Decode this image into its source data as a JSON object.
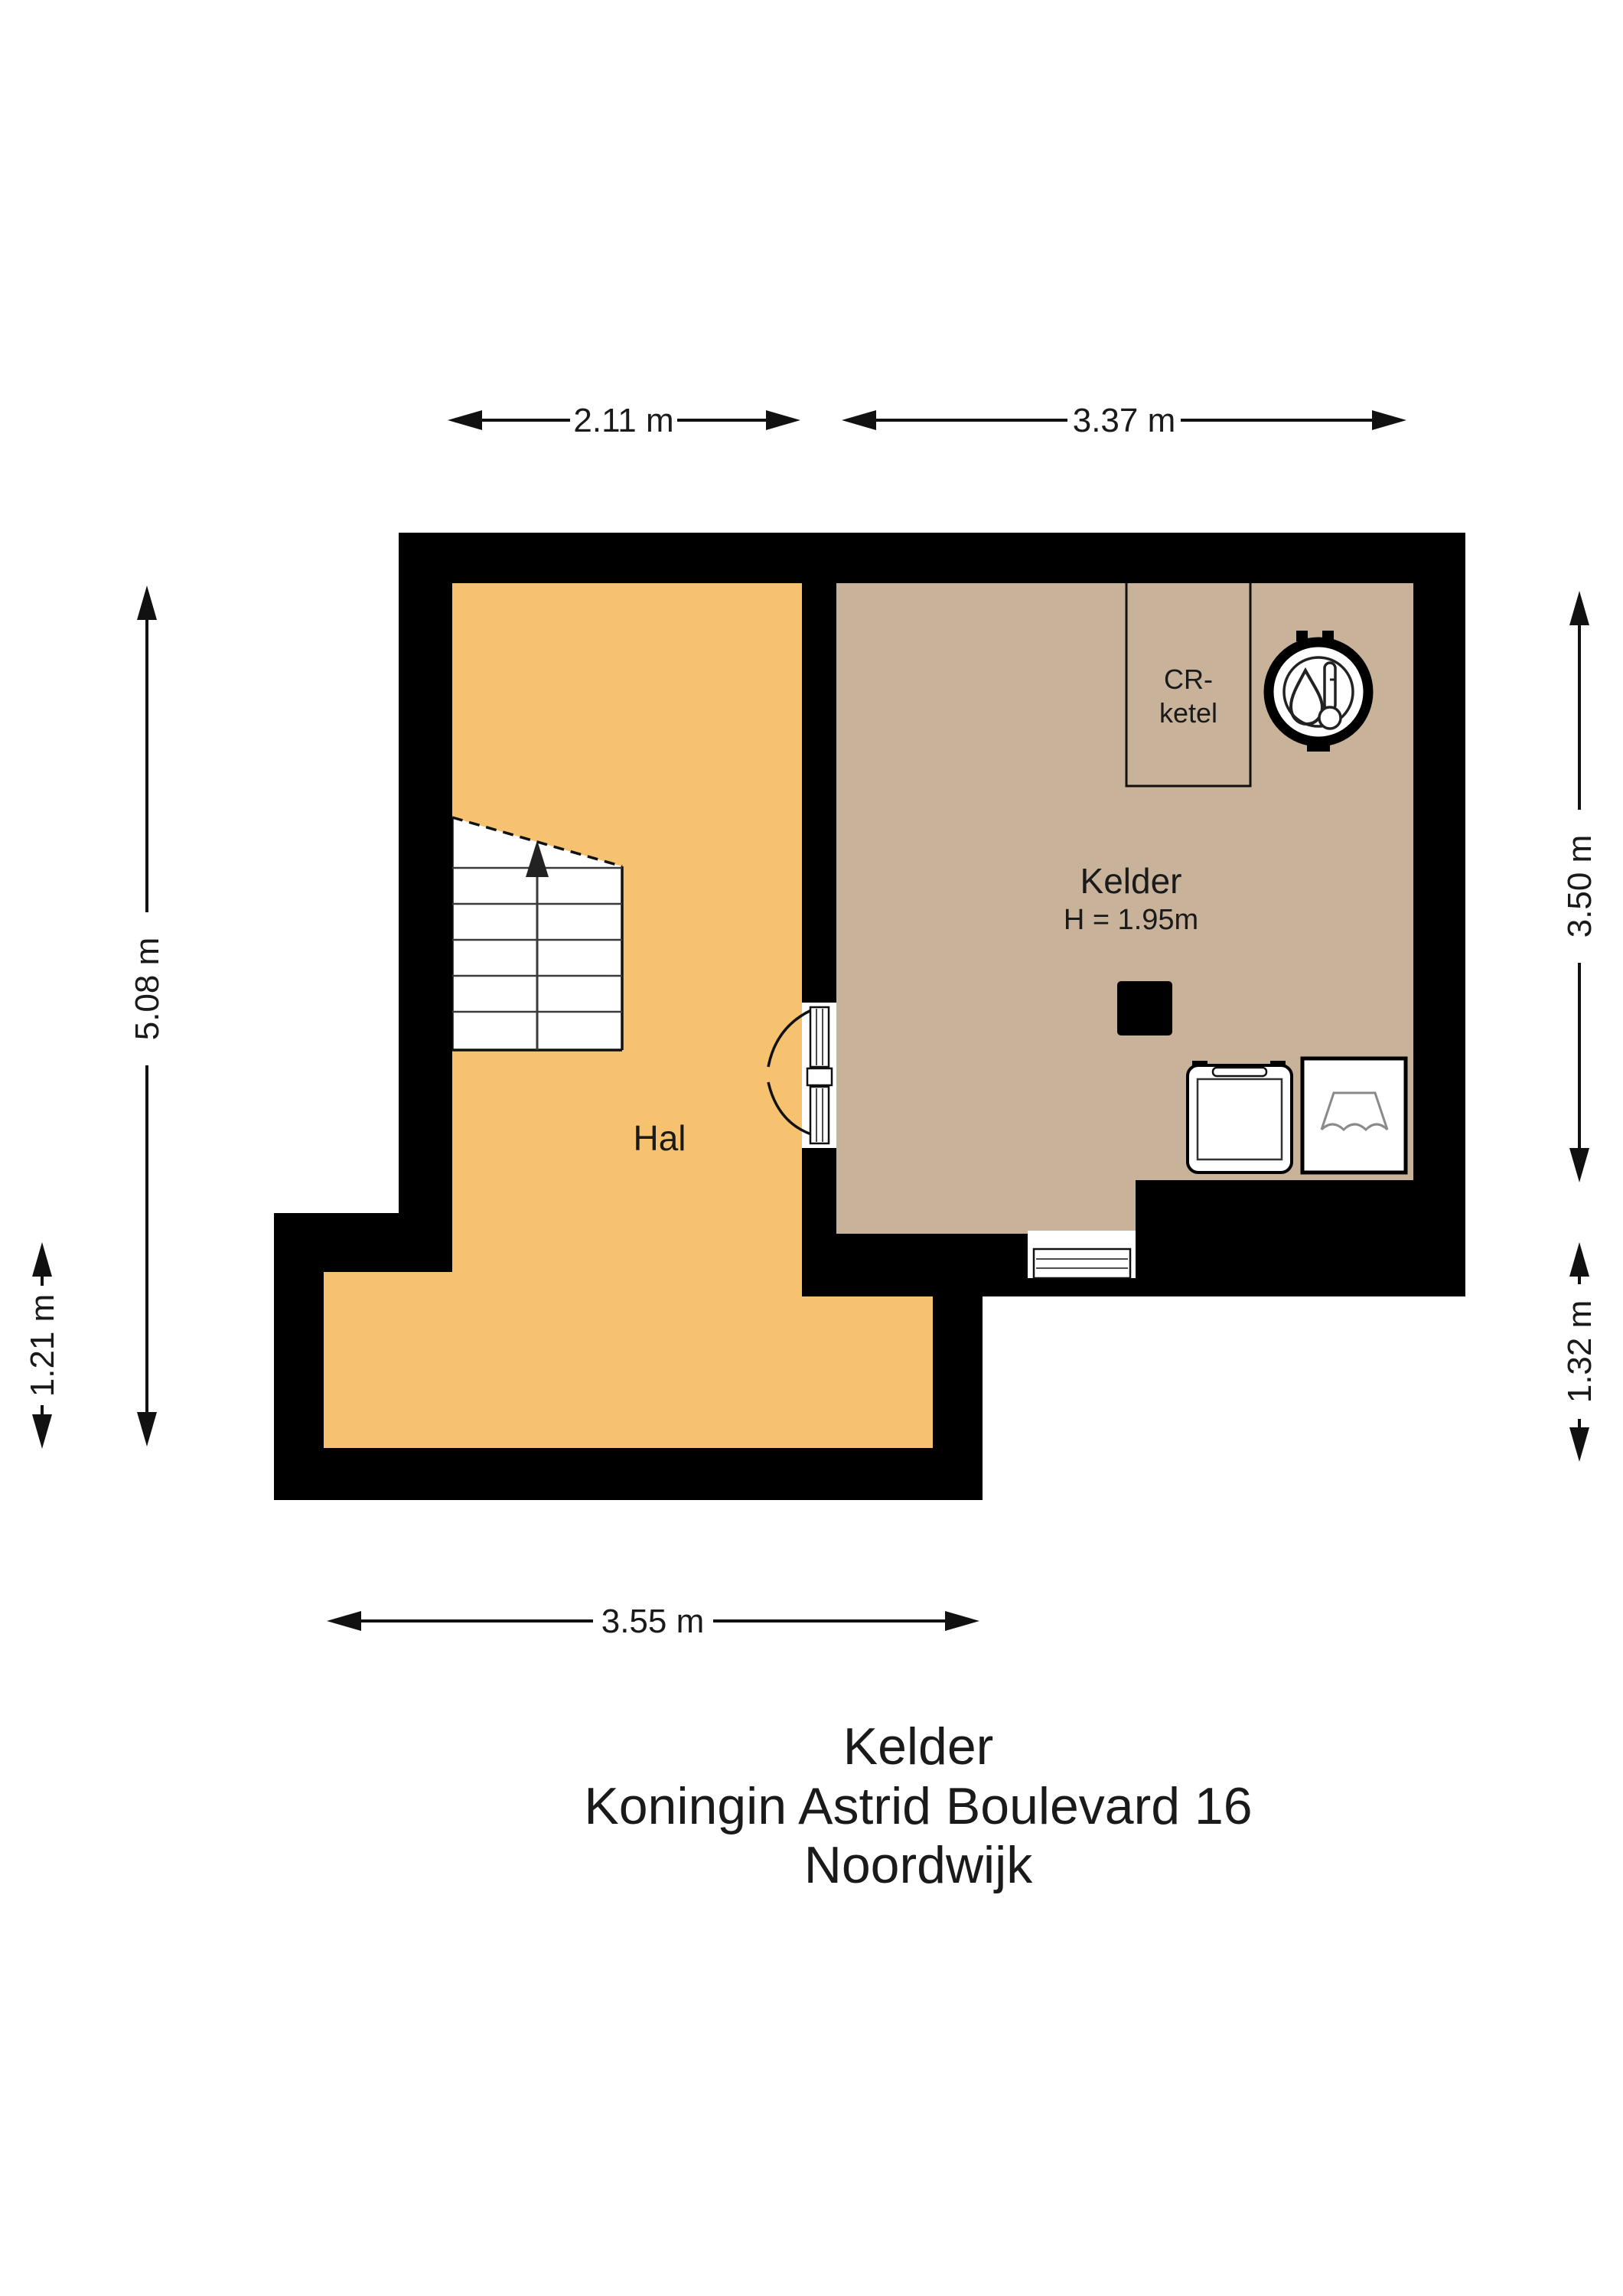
{
  "colors": {
    "hal": "#F7C26F",
    "kelder": "#C8B299",
    "wall": "#000000",
    "white": "#FFFFFF",
    "appliance_detail": "#8a8a8a"
  },
  "rooms": {
    "hal_label": "Hal",
    "kelder_label": "Kelder",
    "kelder_height": "H = 1.95m",
    "closet_line1": "CR-",
    "closet_line2": "ketel"
  },
  "dimensions": {
    "top_left": "2.11 m",
    "top_right": "3.37 m",
    "left_full": "5.08 m",
    "left_lower": "1.21 m",
    "right_upper": "3.50 m",
    "right_lower": "1.32 m",
    "bottom": "3.55 m"
  },
  "title": {
    "line1": "Kelder",
    "line2": "Koningin Astrid Boulevard 16",
    "line3": "Noordwijk"
  }
}
